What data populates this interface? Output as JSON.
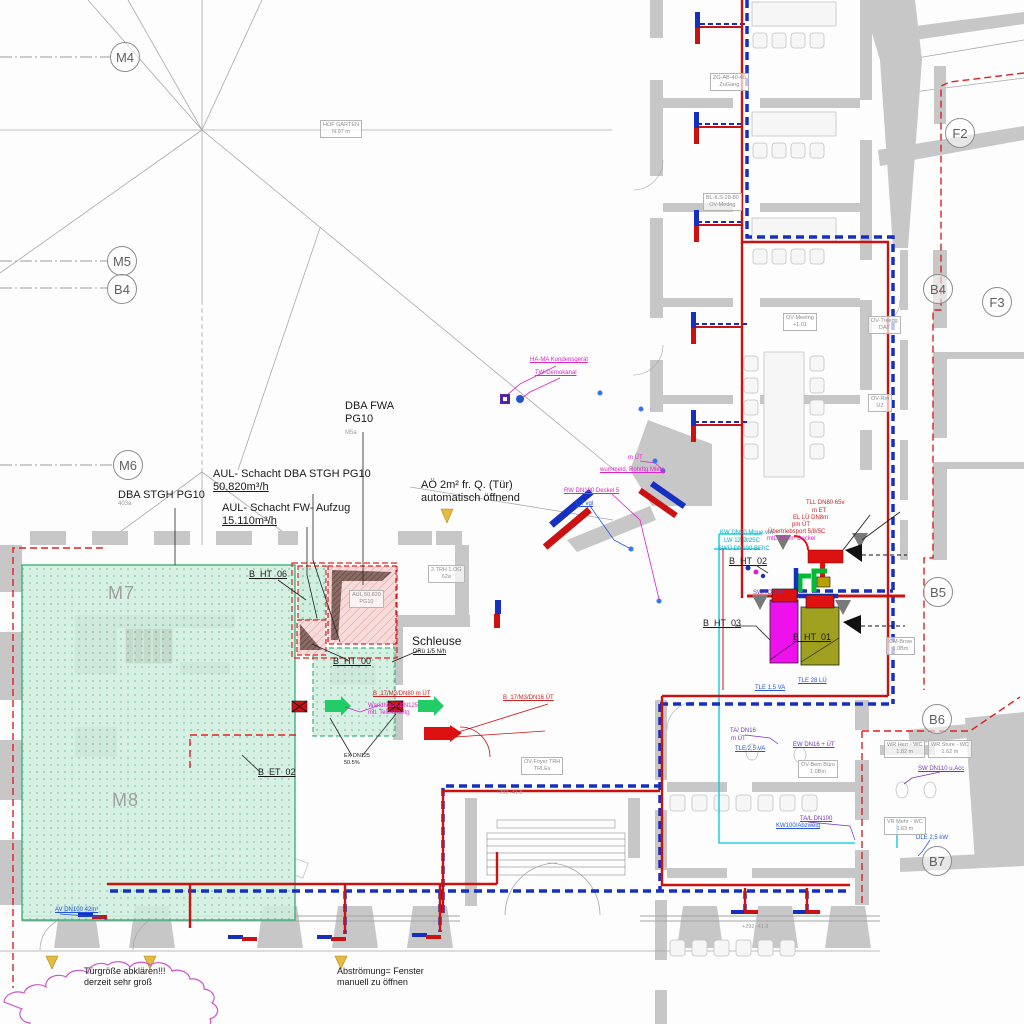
{
  "bubbles": {
    "m4": "M4",
    "m5": "M5",
    "b4l": "B4",
    "m6": "M6",
    "f2": "F2",
    "b4r": "B4",
    "f3": "F3",
    "b5": "B5",
    "b6": "B6",
    "b7": "B7"
  },
  "grid_texts": {
    "m7": "M7",
    "m8": "M8"
  },
  "labels": {
    "dba_fwa_1": "DBA FWA",
    "dba_fwa_2": "PG10",
    "dba_fwa_3": "M5a",
    "aul_dba_1": "AUL- Schacht DBA STGH PG10",
    "aul_dba_2": "50.820m³/h",
    "dba_stgh_1": "DBA STGH PG10",
    "dba_stgh_2": "403a",
    "aul_fw_1": "AUL- Schacht FW- Aufzug",
    "aul_fw_2": "15.110m³/h",
    "b_ht_06": "B_HT_06",
    "b_ht_00": "B_HT_00",
    "b_et_02": "B_ET_02",
    "b_ht_02": "B_HT_02",
    "b_ht_03": "B_HT_03",
    "b_ht_01": "B_HT_01",
    "schleuse": "Schleuse",
    "schleuse_sub": "DRü 1/5 N/h",
    "ao_1": "AÖ 2m² fr. Q. (Tür)",
    "ao_2": "automatisch öffnend",
    "tuer_1": "Türgröße abklären!!!",
    "tuer_2": "derzeit sehr groß",
    "abstroem_1": "Abströmung= Fenster",
    "abstroem_2": "manuell zu öffnen",
    "ex_dn_1": "EX DN125",
    "ex_dn_2": "50.5%"
  },
  "small_texts": {
    "cyan1": "KW DN50 Mque vm",
    "cyan2": "LW 12 Ø/25C",
    "cyan3": "SWÜ DN100 BEhC",
    "red1": "TLL DN80 65v",
    "red2": "m ET",
    "red3": "EL LÜ DN8m",
    "red4": "pm ÜT",
    "red5": "Übertriebsport 5/8/5C",
    "red6": "B_17/M3/DN80 m ÜT",
    "red7": "B_17/M3/DN16 ÜT",
    "mag1": "mtL 100m² Deckel",
    "mag2": "HA-MA Kondensgerät",
    "mag3": "TW-Demokanal",
    "mag4": "m ÜT",
    "mag5": "wummeld. Rohrltg Miete",
    "mag6": "RW DN100 Deckel 5",
    "mag7": "Wandhülse DN125",
    "mag8": "mtl. Telefonleitg",
    "blu1": "ÜT vgl",
    "blu2": "TLE 1,5 VA",
    "blu3": "TLE 28 LÜ",
    "blu4": "AV DN100 42m³",
    "blu5": "DLE 2,5 kW",
    "blu6": "KW100/Abzweig",
    "blu7": "TLE 2,5 VA",
    "pur1": "SWA DN16",
    "pur2": "SW DN110 u.Acc",
    "pur3": "TA/L DN100",
    "pur4": "TA/ DN16",
    "pur5": "m ÜT",
    "pur6": "EW DN16 + ÜT",
    "gry1": "+292 -41.8",
    "gry2": "+292 -41.8"
  },
  "rooms": [
    {
      "l1": "ZG-AB-40-40",
      "l2": "ZuGang"
    },
    {
      "l1": "BL-ILS-28-80",
      "l2": "OV-Medng"
    },
    {
      "l1": "OV-Meetng",
      "l2": "+1.01"
    },
    {
      "l1": "OV-Treedg",
      "l2": "DAT"
    },
    {
      "l1": "OV-Rm",
      "l2": "ÜZ"
    },
    {
      "l1": "OV-Bem Büro",
      "l2": "1.0Bm"
    },
    {
      "l1": "OV-Foyer TRH",
      "l2": "TRLEx"
    },
    {
      "l1": "CM-Brow",
      "l2": "1.0Bm"
    },
    {
      "l1": "WR Herr - WC",
      "l2": "1.82 m"
    },
    {
      "l1": "WR Sture - WC",
      "l2": "1.62 m"
    },
    {
      "l1": "VR Mehr - WC",
      "l2": "1.63 m"
    },
    {
      "l1": "AUL 50.820",
      "l2": "PG10"
    },
    {
      "l1": "HOF GARTEN",
      "l2": "N.97 m"
    },
    {
      "l1": "2.TRH 1.OG",
      "l2": "62a"
    }
  ],
  "colors": {
    "duct_red": "#cc1111",
    "duct_blue": "#1530c0",
    "cyan_pipe": "#00c5dd",
    "green_zone_fill": "#cfeede",
    "green_zone_border": "#3cb37a",
    "pink_shaft": "#f7dada",
    "shaft_border_red": "#dd2222",
    "magenta_box": "#ee11ee",
    "olive_box": "#a0a020",
    "bright_green": "#00bb33",
    "revision_cloud": "#cc55cc",
    "arrow_yellow": "#e6b93f",
    "wall_gray": "#c7c7c7"
  }
}
